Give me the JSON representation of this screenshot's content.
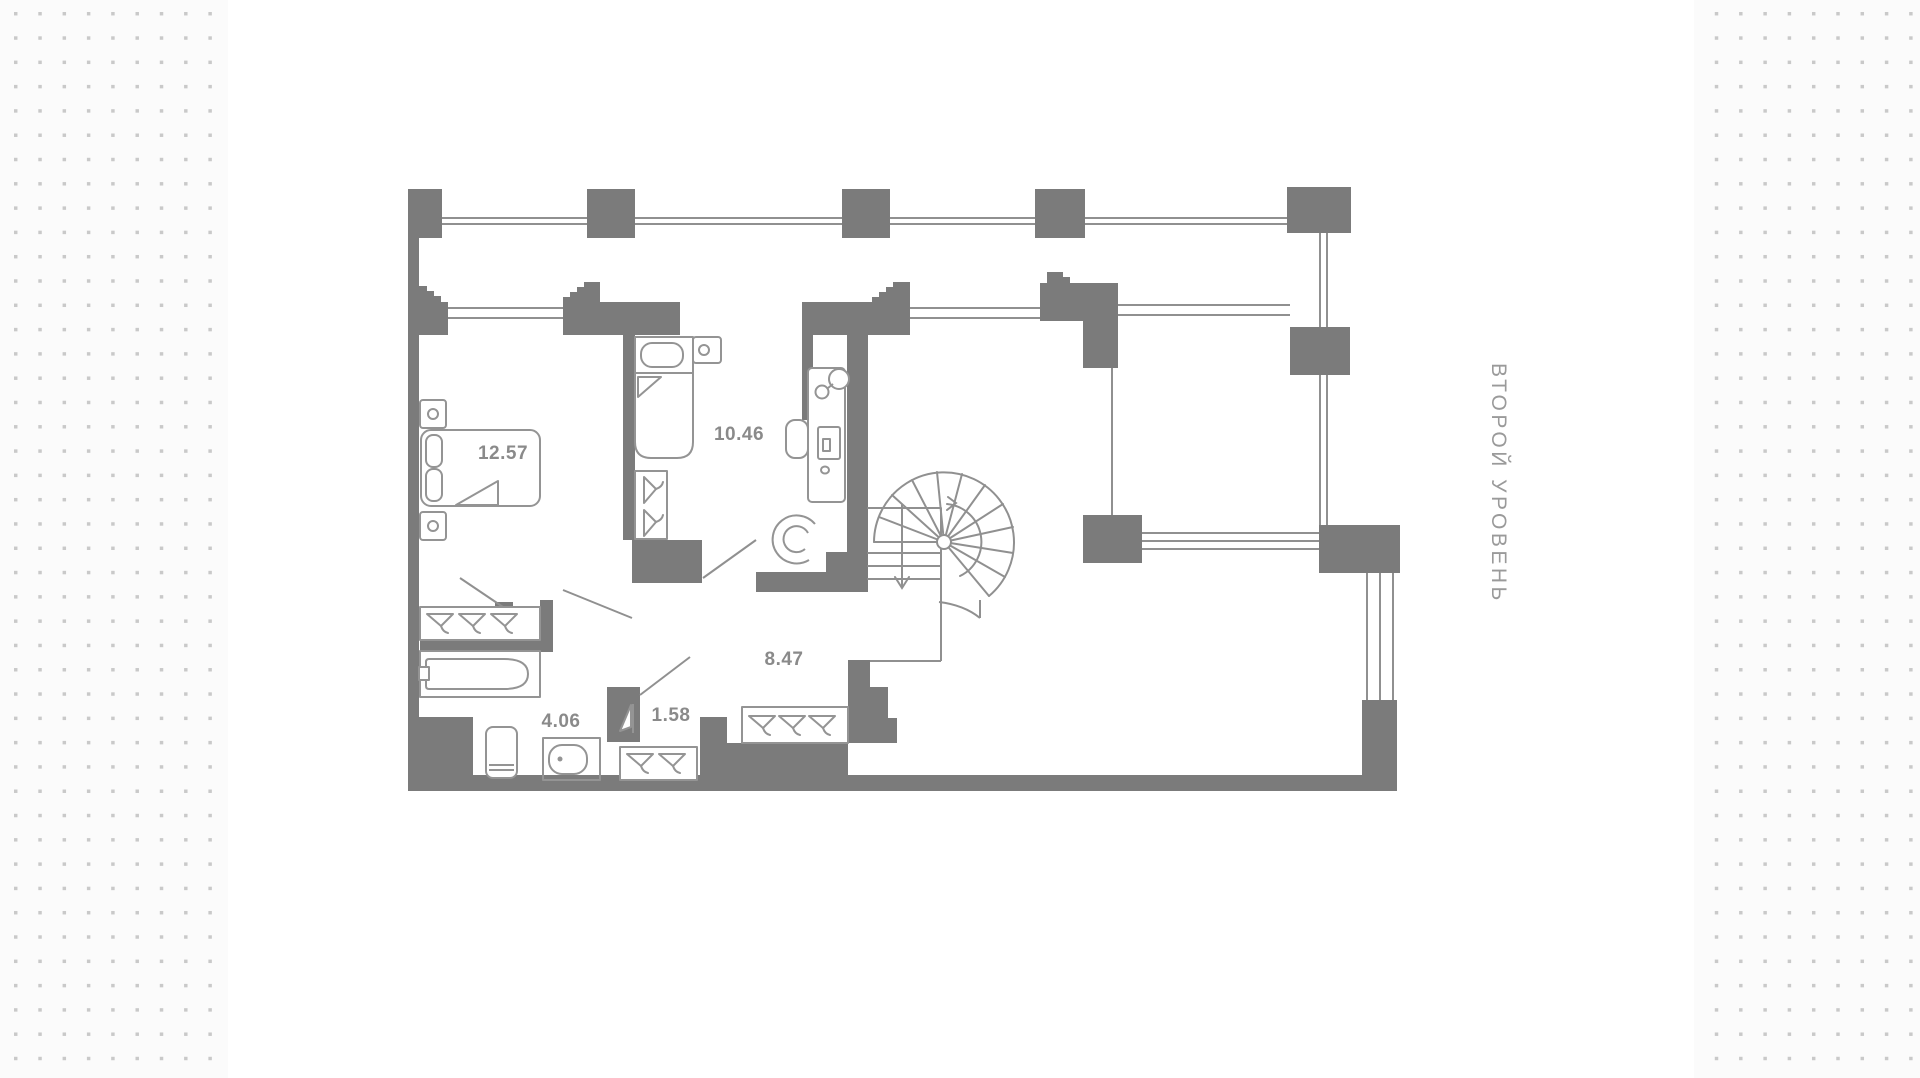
{
  "page": {
    "background_color": "#fbfbfb",
    "dot_color": "#c9c9c9",
    "card_color": "#ffffff"
  },
  "plan": {
    "wall_color": "#7b7b7b",
    "window_line_color": "#909090",
    "furniture_line_color": "#949494",
    "room_label_color": "#8a8a8a",
    "side_label": "ВТОРОЙ УРОВЕНЬ",
    "side_label_color": "#9a9a9a",
    "rooms": [
      {
        "name": "bedroom",
        "area": "12.57"
      },
      {
        "name": "cabinet",
        "area": "10.46"
      },
      {
        "name": "hall-stairs",
        "area": "8.47"
      },
      {
        "name": "bathroom",
        "area": "4.06"
      },
      {
        "name": "wardrobe-hall",
        "area": "1.58"
      }
    ]
  }
}
